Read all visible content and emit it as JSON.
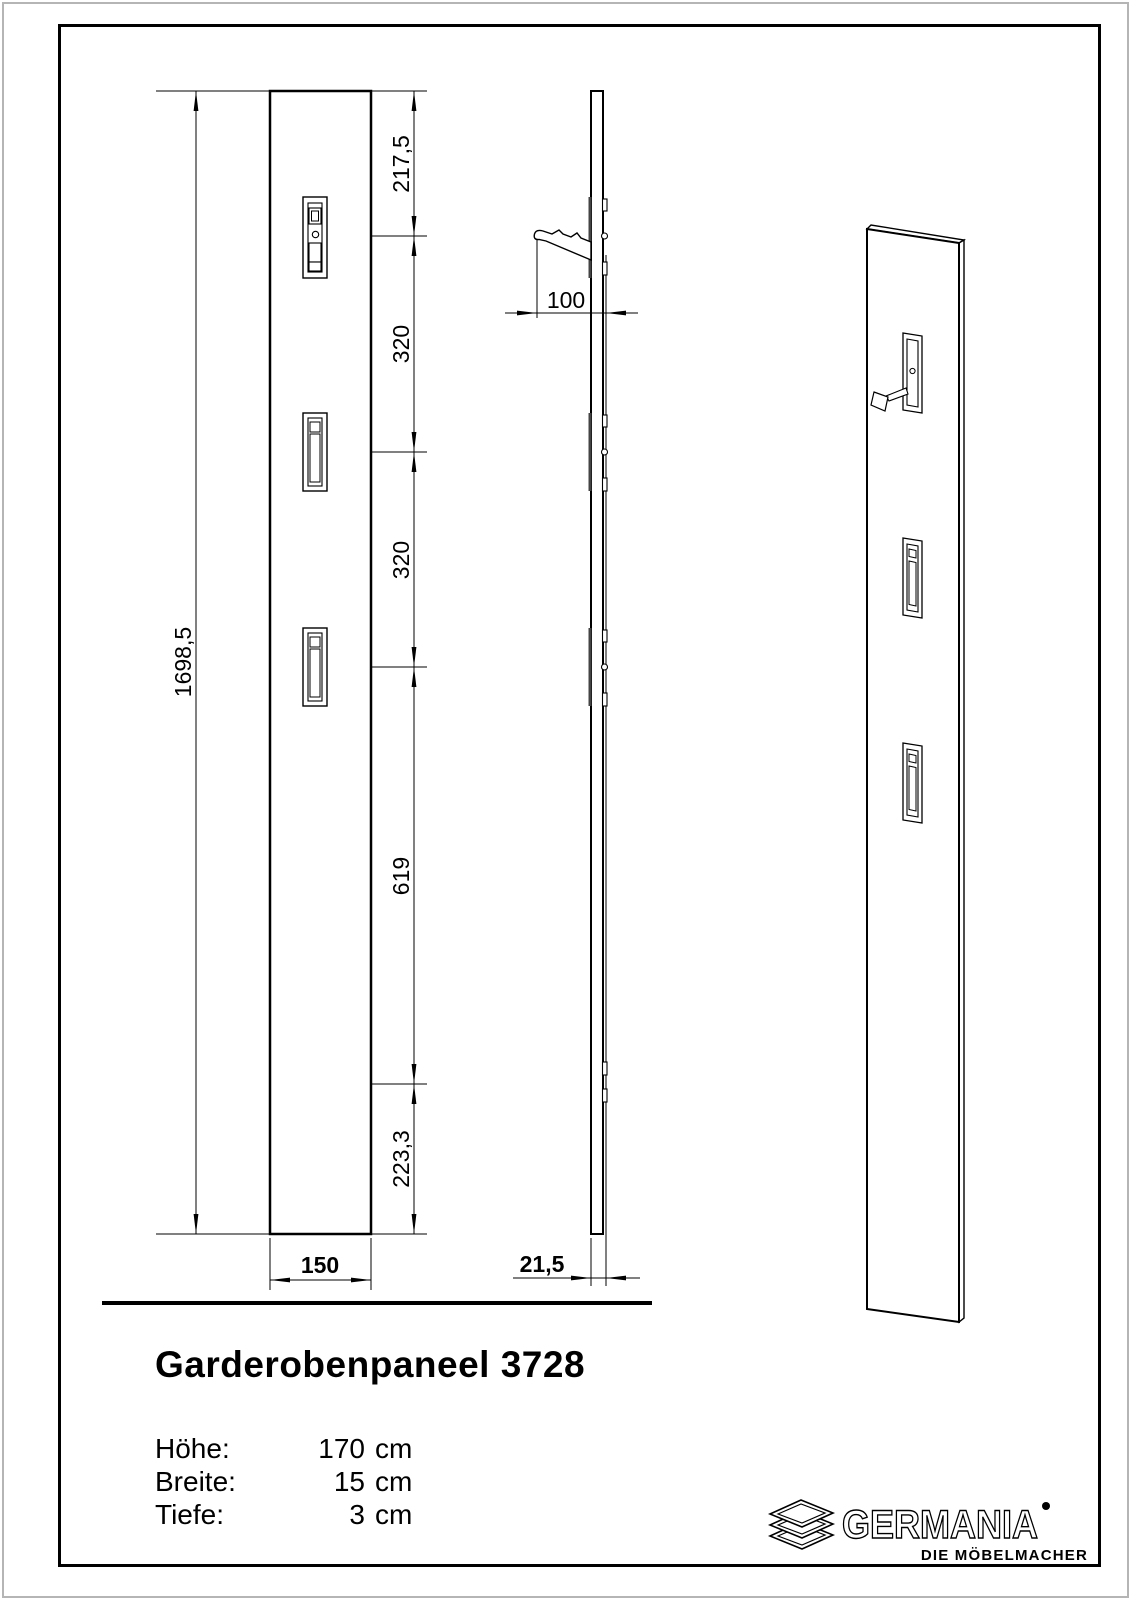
{
  "page": {
    "background": "#ffffff",
    "line_color": "#000000",
    "border_gray": "#b5b5b5"
  },
  "front_view": {
    "dims": {
      "overall_height": "1698,5",
      "top_to_hook1": "217,5",
      "hook1_to_hook2": "320",
      "hook2_to_hook3": "320",
      "hook3_to_bracket": "619",
      "bracket_to_bottom": "223,3",
      "width": "150"
    }
  },
  "side_view": {
    "dims": {
      "hook_projection": "100",
      "panel_depth": "21,5"
    }
  },
  "title_block": {
    "title": "Garderobenpaneel 3728",
    "specs": [
      {
        "label": "Höhe:",
        "value": "170",
        "unit": "cm"
      },
      {
        "label": "Breite:",
        "value": "15",
        "unit": "cm"
      },
      {
        "label": "Tiefe:",
        "value": "3",
        "unit": "cm"
      }
    ]
  },
  "logo": {
    "brand": "GERMANIA",
    "tagline": "DIE MÖBELMACHER",
    "icon": "stacked-panels-icon",
    "registered_mark": "•"
  }
}
